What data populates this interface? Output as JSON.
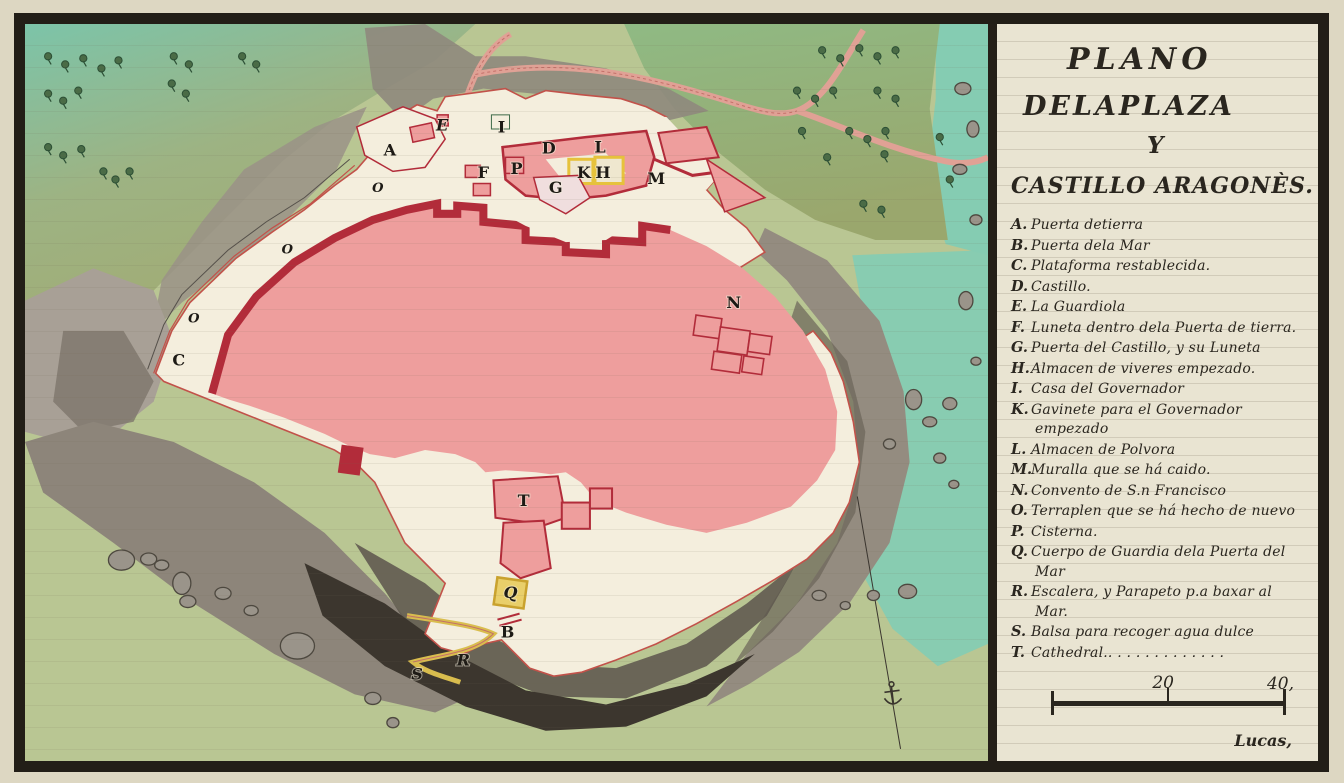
{
  "panel": {
    "title_lines": [
      "PLANO",
      "DELAPLAZA",
      "Y",
      "CASTILLO ARAGONÈS."
    ],
    "legend_items": [
      {
        "letter": "A.",
        "text": "Puerta detierra"
      },
      {
        "letter": "B.",
        "text": "Puerta dela Mar"
      },
      {
        "letter": "C.",
        "text": "Plataforma restablecida."
      },
      {
        "letter": "D.",
        "text": "Castillo."
      },
      {
        "letter": "E.",
        "text": "La Guardiola"
      },
      {
        "letter": "F.",
        "text": "Luneta dentro dela Puerta de tierra."
      },
      {
        "letter": "G.",
        "text": "Puerta del Castillo, y su Luneta"
      },
      {
        "letter": "H.",
        "text": "Almacen de viveres empezado."
      },
      {
        "letter": "I.",
        "text": "Casa del Governador"
      },
      {
        "letter": "K.",
        "text": "Gavinete para el Governador empezado"
      },
      {
        "letter": "L.",
        "text": "Almacen de Polvora"
      },
      {
        "letter": "M.",
        "text": "Muralla que se há caido."
      },
      {
        "letter": "N.",
        "text": "Convento de S.n Francisco"
      },
      {
        "letter": "O.",
        "text": "Terraplen que se há hecho de nuevo"
      },
      {
        "letter": "P.",
        "text": "Cisterna."
      },
      {
        "letter": "Q.",
        "text": "Cuerpo de Guardia dela Puerta del Mar"
      },
      {
        "letter": "R.",
        "text": "Escalera, y Parapeto p.a baxar al Mar."
      },
      {
        "letter": "S.",
        "text": "Balsa para recoger agua dulce"
      },
      {
        "letter": "T.",
        "text": "Cathedral.. . . . . . . . . . . . ."
      }
    ],
    "scale_bar": {
      "mid_label": "20",
      "end_label": "40,"
    },
    "signature": "Lucas,"
  },
  "map": {
    "labels": [
      {
        "t": "A",
        "x": 385,
        "y": 152
      },
      {
        "t": "B",
        "x": 502,
        "y": 629
      },
      {
        "t": "C",
        "x": 175,
        "y": 360
      },
      {
        "t": "D",
        "x": 543,
        "y": 150
      },
      {
        "t": "E",
        "x": 437,
        "y": 127
      },
      {
        "t": "F",
        "x": 478,
        "y": 174
      },
      {
        "t": "G",
        "x": 550,
        "y": 189
      },
      {
        "t": "H",
        "x": 597,
        "y": 174
      },
      {
        "t": "I",
        "x": 496,
        "y": 129
      },
      {
        "t": "K",
        "x": 578,
        "y": 174
      },
      {
        "t": "L",
        "x": 594,
        "y": 149
      },
      {
        "t": "M",
        "x": 650,
        "y": 180
      },
      {
        "t": "N",
        "x": 727,
        "y": 303
      },
      {
        "t": "O",
        "x": 373,
        "y": 189
      },
      {
        "t": "O",
        "x": 283,
        "y": 250
      },
      {
        "t": "O",
        "x": 190,
        "y": 318
      },
      {
        "t": "P",
        "x": 511,
        "y": 170
      },
      {
        "t": "Q",
        "x": 505,
        "y": 590
      },
      {
        "t": "R",
        "x": 458,
        "y": 657
      },
      {
        "t": "S",
        "x": 412,
        "y": 671
      },
      {
        "t": "T",
        "x": 518,
        "y": 499
      }
    ],
    "palette": {
      "paper": "#e9e4d2",
      "ink": "#2a261f",
      "plaza_pink": "#ee9e9d",
      "rampart_red": "#b22c3a",
      "wall_red": "#c2524a",
      "plateau_cream": "#f4eedd",
      "sea_green": "#b9c693",
      "sea_teal": "#85ccb2",
      "hill_olive": "#9aa76d",
      "hill_teal": "#7cc4a9",
      "cliff_gray": "#8d857a",
      "cliff_dark": "#3c362e",
      "accent_yellow": "#e6c23c",
      "tree_green": "#4a6b46"
    }
  }
}
